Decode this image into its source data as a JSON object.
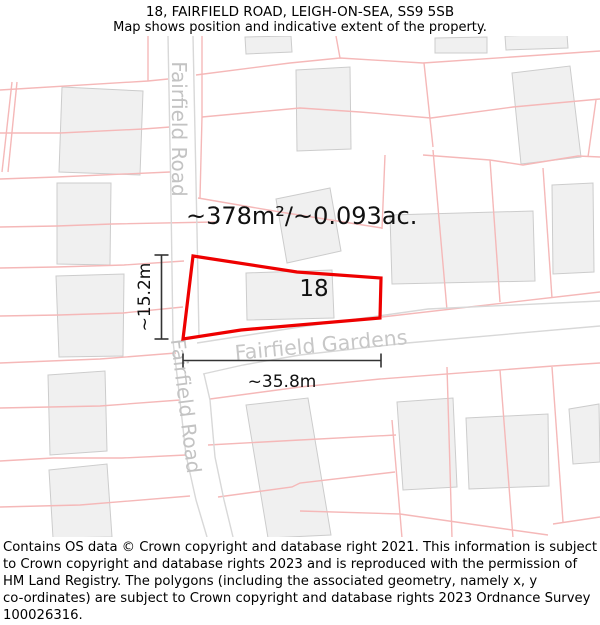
{
  "header": {
    "title": "18, FAIRFIELD ROAD, LEIGH-ON-SEA, SS9 5SB",
    "subtitle": "Map shows position and indicative extent of the property."
  },
  "footer": {
    "lines": [
      "Contains OS data © Crown copyright and database right 2021. This information is subject",
      "to Crown copyright and database rights 2023 and is reproduced with the permission of",
      "HM Land Registry. The polygons (including the associated geometry, namely x, y",
      "co-ordinates) are subject to Crown copyright and database rights 2023 Ordnance Survey",
      "100026316."
    ]
  },
  "map": {
    "colors": {
      "parcel_line": "#f5b8b8",
      "road_line": "#d8d8d8",
      "building_fill": "#f0f0f0",
      "building_stroke": "#cccccc",
      "property_outline": "#ee0000",
      "dimension": "#333333",
      "street_text": "#c3c3c3",
      "label_text": "#111111"
    },
    "buildings": [
      "62,87 143,91 140,175 59,172",
      "57,183 111,183 110,265 57,264",
      "56,276 124,274 123,356 59,357",
      "48,375 105,371 107,451 50,455",
      "49,470 107,464 112,537 53,538",
      "245,37 291,36 292,52 246,54",
      "296,70 350,67 351,149 297,151",
      "512,73 570,66 581,157 521,164",
      "435,38 487,37 487,53 435,53",
      "505,36 567,34 568,48 506,50",
      "276,199 330,188 341,251 287,263",
      "246,273 332,270 334,318 247,320",
      "390,215 533,211 535,281 392,284",
      "552,185 593,183 594,272 553,274",
      "397,402 453,398 457,487 403,490",
      "466,418 548,414 549,486 469,489",
      "569,409 599,404 600,462 573,464",
      "246,405 308,398 331,535 268,538"
    ],
    "parcel_lines": [
      "0,90 148,81 168,79",
      "148,36 148,81",
      "12,82 2,172",
      "17,82 8,172",
      "0,133 60,133 143,129 170,127",
      "0,179 57,177 170,172",
      "0,227 57,226 112,224 215,222",
      "0,268 56,267 124,265 184,261",
      "0,316 59,315 123,313 183,307",
      "0,363 100,359 176,353",
      "0,408 100,406 180,400",
      "0,461 53,458 122,458 186,455",
      "0,507 80,505 190,496",
      "196,75 290,63 340,58 423,63",
      "423,63 600,51",
      "336,36 340,58",
      "202,36 202,117",
      "202,117 200,198",
      "202,117 300,108 360,112 431,118 513,107 600,99",
      "424,63 433,147",
      "423,155 490,160 523,165 578,156 600,157",
      "596,100 588,157",
      "490,160 500,302",
      "433,150 447,310",
      "543,168 552,298",
      "385,155 382,229",
      "198,198 280,212 382,228",
      "382,317 600,292",
      "210,399 300,387 380,379 553,366 600,363",
      "208,445 300,440 396,435",
      "218,497 292,487 300,483 395,472",
      "300,511 400,514 470,524 548,535",
      "553,524 600,517",
      "447,367 452,538",
      "500,370 513,538",
      "552,367 563,522",
      "392,420 402,538"
    ],
    "roads": [
      "168,36 171,200 173,341 179,392 186,455 196,500 207,537",
      "193,36 197,230 199,338",
      "204,374 210,400 215,457 224,500 233,537",
      "197,343 300,327 428,309 600,301",
      "203,374 243,365 300,355 407,343 600,326"
    ],
    "property": {
      "points": "193,256 297,272 381,278 380,318 241,330 183,339",
      "number": "18"
    },
    "dimension_lines": [
      {
        "name": "dim-height-line",
        "x1": 161.5,
        "y1": 255,
        "x2": 161.5,
        "y2": 339
      },
      {
        "name": "dim-height-cap-top",
        "x1": 154.5,
        "y1": 255,
        "x2": 168.5,
        "y2": 255
      },
      {
        "name": "dim-height-cap-bottom",
        "x1": 154.5,
        "y1": 339,
        "x2": 168.5,
        "y2": 339
      },
      {
        "name": "dim-width-line",
        "x1": 183,
        "y1": 360.5,
        "x2": 381,
        "y2": 360.5
      },
      {
        "name": "dim-width-cap-left",
        "x1": 183,
        "y1": 353.5,
        "x2": 183,
        "y2": 367.5
      },
      {
        "name": "dim-width-cap-right",
        "x1": 381,
        "y1": 353.5,
        "x2": 381,
        "y2": 367.5
      }
    ],
    "labels": [
      {
        "name": "street-label-fairfield-road-top",
        "text": "Fairfield Road",
        "x": 179,
        "y": 129,
        "rotate": 90,
        "size": 20,
        "color": "#c3c3c3",
        "anchor": "middle",
        "middle": true
      },
      {
        "name": "street-label-fairfield-road-bottom",
        "text": "Fairfield Road",
        "x": 186,
        "y": 406,
        "rotate": 83,
        "size": 20,
        "color": "#c3c3c3",
        "anchor": "middle",
        "middle": true
      },
      {
        "name": "street-label-fairfield-gardens",
        "text": "Fairfield Gardens",
        "x": 321,
        "y": 345,
        "rotate": -5.3,
        "size": 20.5,
        "color": "#c7c7c7",
        "anchor": "middle",
        "middle": true
      },
      {
        "name": "area-label",
        "text": "~378m²/~0.093ac.",
        "x": 186,
        "y": 224,
        "rotate": 0,
        "size": 24,
        "color": "#111111",
        "anchor": "start",
        "middle": false
      },
      {
        "name": "plot-number-label",
        "text": "18",
        "x": 314,
        "y": 289,
        "rotate": 0,
        "size": 23,
        "color": "#111111",
        "anchor": "middle",
        "middle": true
      },
      {
        "name": "dim-height-label",
        "text": "~15.2m",
        "x": 145,
        "y": 297,
        "rotate": -90,
        "size": 17,
        "color": "#111111",
        "anchor": "middle",
        "middle": true
      },
      {
        "name": "dim-width-label",
        "text": "~35.8m",
        "x": 282,
        "y": 382,
        "rotate": 0,
        "size": 17,
        "color": "#111111",
        "anchor": "middle",
        "middle": true
      }
    ]
  }
}
